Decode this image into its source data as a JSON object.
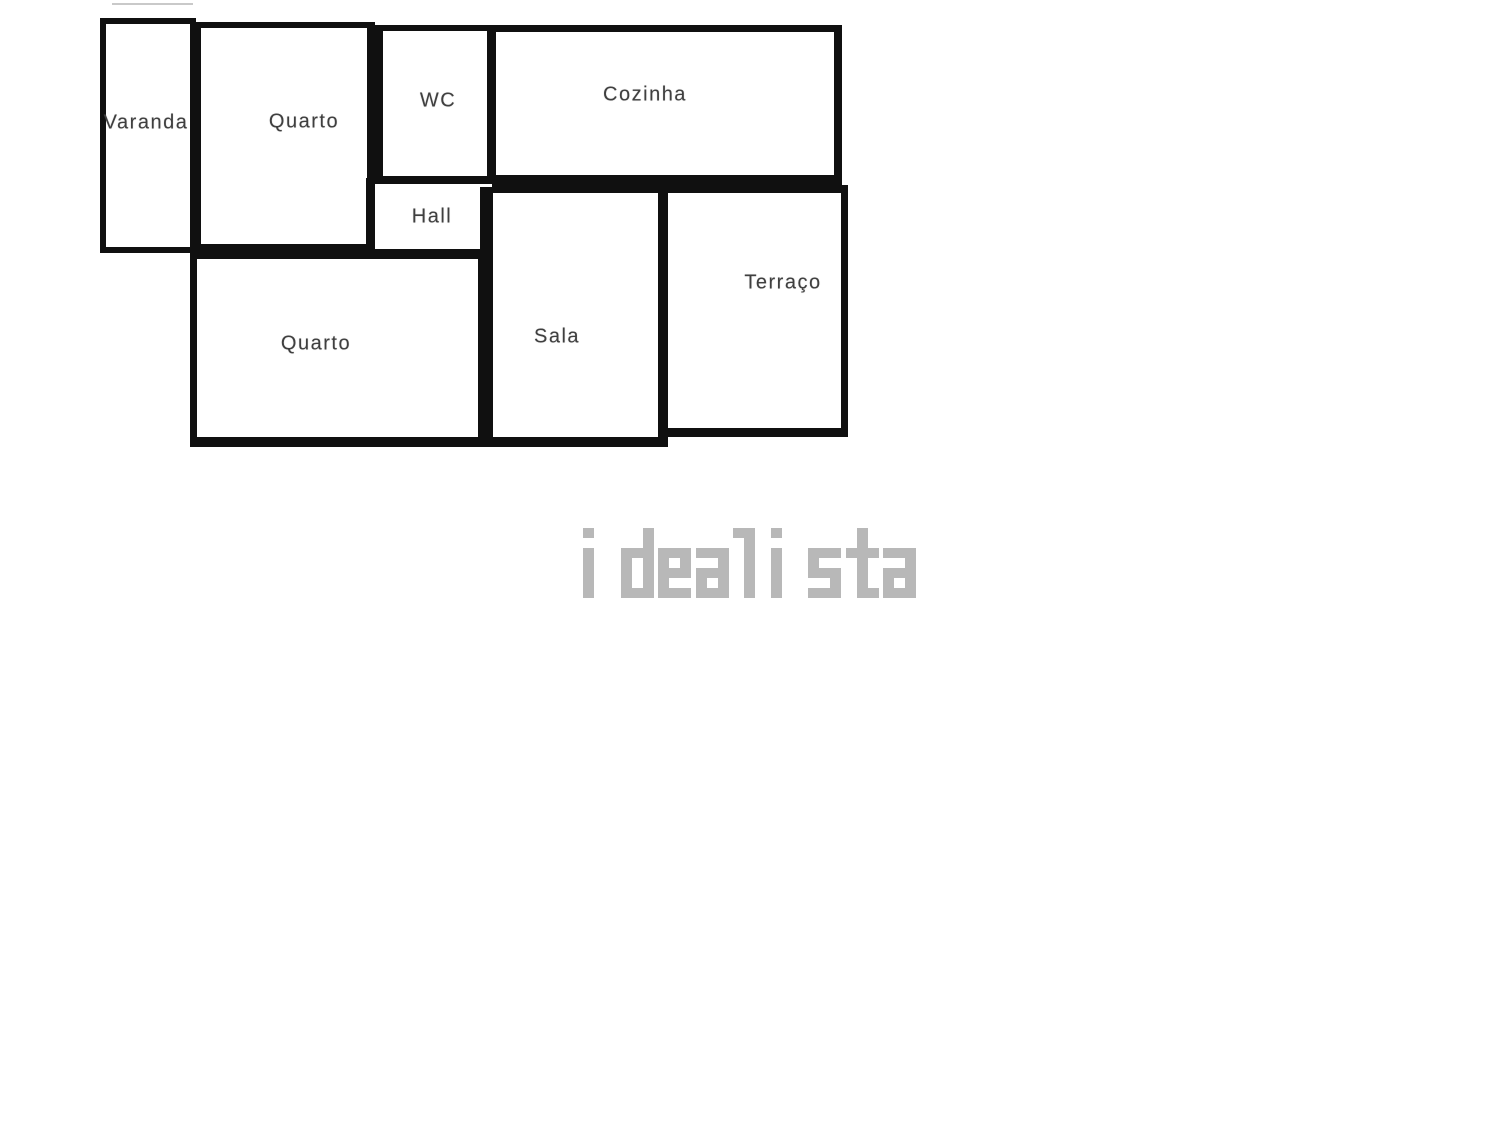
{
  "page": {
    "background_color": "#ffffff"
  },
  "floorplan": {
    "wall_color": "#101010",
    "label_color": "#3f3f3f",
    "rooms": [
      {
        "id": "varanda",
        "label": "Varanda",
        "x": 100,
        "y": 18,
        "w": 96,
        "h": 235,
        "bt": 6,
        "br": 6,
        "bb": 6,
        "bl": 6,
        "lx": 146,
        "ly": 123
      },
      {
        "id": "quarto-1",
        "label": "Quarto",
        "x": 195,
        "y": 22,
        "w": 180,
        "h": 233,
        "bt": 6,
        "br": 8,
        "bb": 11,
        "bl": 6,
        "lx": 304,
        "ly": 122
      },
      {
        "id": "wc",
        "label": "WC",
        "x": 375,
        "y": 25,
        "w": 119,
        "h": 160,
        "bt": 6,
        "br": 7,
        "bb": 9,
        "bl": 8,
        "lx": 438,
        "ly": 101
      },
      {
        "id": "cozinha",
        "label": "Cozinha",
        "x": 489,
        "y": 25,
        "w": 353,
        "h": 162,
        "bt": 7,
        "br": 8,
        "bb": 12,
        "bl": 7,
        "lx": 645,
        "ly": 95
      },
      {
        "id": "hall",
        "label": "Hall",
        "x": 366,
        "y": 178,
        "w": 136,
        "h": 82,
        "bt": 6,
        "br": 10,
        "bb": 11,
        "bl": 9,
        "lx": 432,
        "ly": 217
      },
      {
        "id": "quarto-2",
        "label": "Quarto",
        "x": 190,
        "y": 250,
        "w": 300,
        "h": 197,
        "bt": 9,
        "br": 12,
        "bb": 10,
        "bl": 7,
        "lx": 316,
        "ly": 344
      },
      {
        "id": "sala",
        "label": "Sala",
        "x": 480,
        "y": 187,
        "w": 188,
        "h": 260,
        "bt": 6,
        "br": 10,
        "bb": 10,
        "bl": 13,
        "lx": 557,
        "ly": 337
      },
      {
        "id": "terraco",
        "label": "Terraço",
        "x": 658,
        "y": 185,
        "w": 190,
        "h": 252,
        "bt": 8,
        "br": 7,
        "bb": 9,
        "bl": 10,
        "lx": 783,
        "ly": 283
      }
    ],
    "artifact_line": {
      "x": 112,
      "y": 3,
      "w": 81,
      "h": 2,
      "color": "#c9c9c9"
    }
  },
  "watermark": {
    "text": "idealista",
    "color": "#b8b8b8",
    "x": 583,
    "y": 528,
    "pixel_w": 11,
    "pixel_h": 10,
    "advance": 37.5
  }
}
